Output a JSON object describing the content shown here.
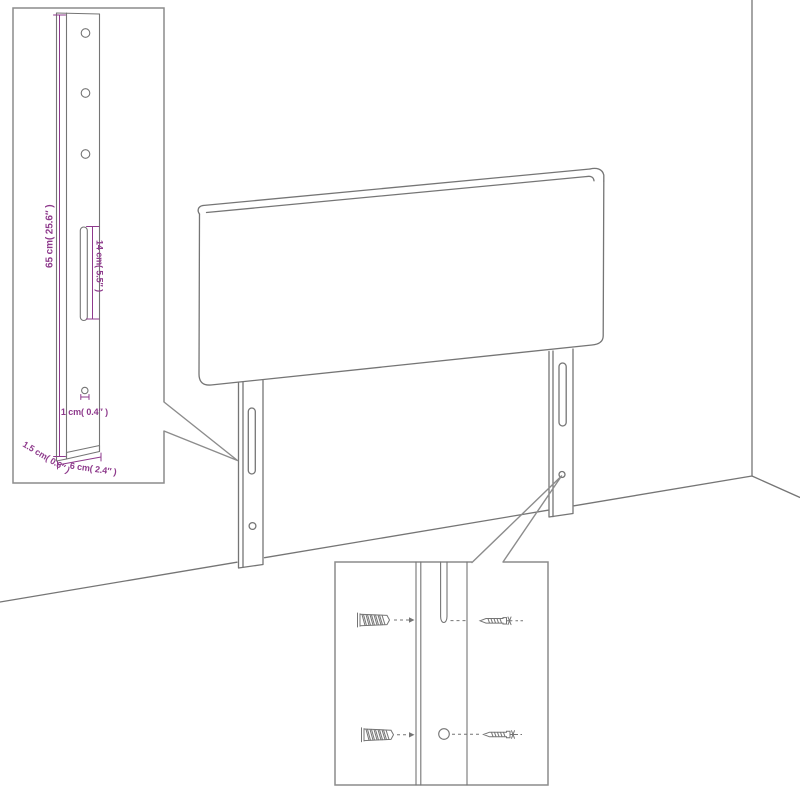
{
  "page": {
    "background": "#ffffff"
  },
  "colors": {
    "drawing_line": "#757575",
    "callout_border": "#8c8c8c",
    "dimension": "#8e3a8c"
  },
  "diagram": {
    "subject": "headboard-with-mounting-legs-in-room-corner"
  },
  "labels": {
    "leg_height": "65 cm( 25.6″ )",
    "slot_length": "14 cm( 5.5″ )",
    "hole_diameter": "1 cm( 0.4″ )",
    "leg_thickness": "1.5 cm( 0.6″ )",
    "leg_width": "6 cm( 2.4″ )"
  }
}
